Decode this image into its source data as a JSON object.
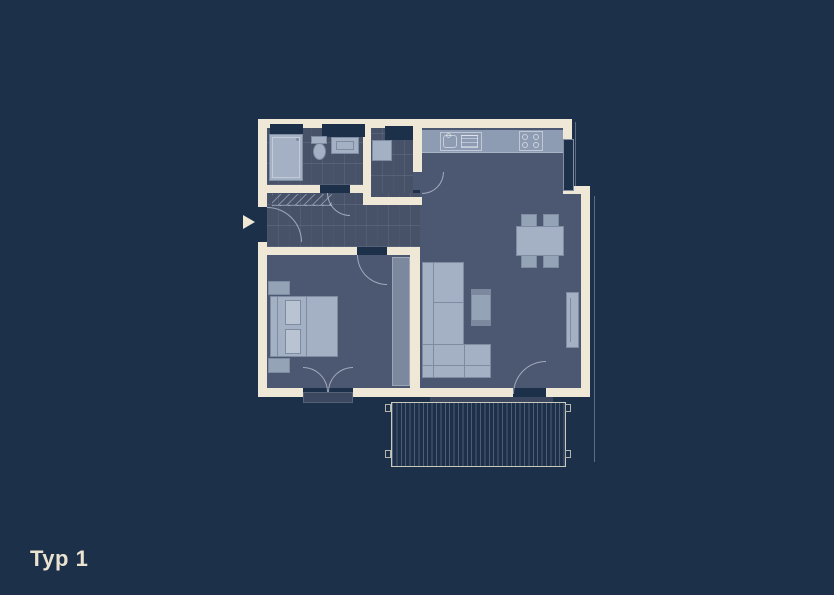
{
  "title": {
    "label": "Typ 1"
  },
  "plan": {
    "marker_icon": "entrance-arrow",
    "colors": {
      "background": "#1d3049",
      "wall": "#efe8d6",
      "floor": "#4c5871",
      "tile": "#475269",
      "furniture": "#a4b0c3",
      "furniture_light": "#b9c3d2",
      "furniture_mid": "#95a3b7",
      "furniture_dark": "#7b889e",
      "counter": "#8d9cb2",
      "threshold": "#3a475f",
      "outline": "#7e8ca2",
      "text": "#eae3d0"
    }
  }
}
